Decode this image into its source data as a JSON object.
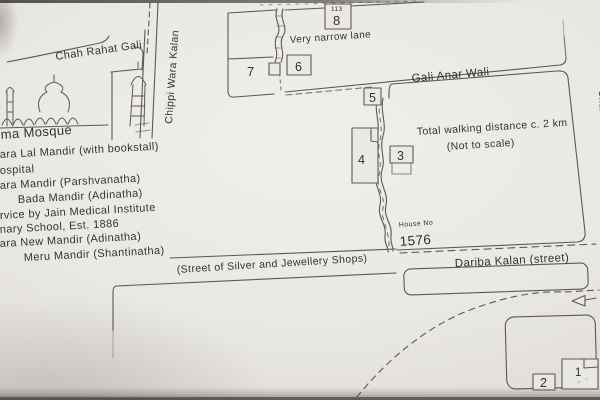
{
  "map": {
    "street_labels": {
      "chah_rahat_gali": "Chah Rahat Gali",
      "chippi_wara_kalan": "Chippi Wara Kalan",
      "very_narrow_lane": "Very narrow lane",
      "gali_anar_wali": "Gali Anar Wali",
      "silver_street": "(Street of Silver and Jewellery Shops)",
      "dariba_kalan": "Dariba Kalan (street)",
      "right_edge_street": "Chah"
    },
    "annotations": {
      "mosque": "ma Mosque",
      "house_no_label": "House No",
      "house_no_value": "1576",
      "walking_note_line1": "Total walking distance c. 2 km",
      "walking_note_line2": "(Not to scale)"
    },
    "markers": {
      "m1": "1",
      "m2": "2",
      "m3": "3",
      "m4": "4",
      "m5": "5",
      "m6": "6",
      "m7": "7",
      "m8": "8",
      "m8_sub": "113"
    },
    "legend": [
      "ara Lal Mandir (with bookstall)",
      "ospital",
      "ara Mandir (Parshvanatha)",
      "Bada Mandir (Adinatha)",
      "rvice by Jain Medical Institute",
      "nary School, Est. 1886",
      "ara New Mandir (Adinatha)",
      "Meru Mandir (Shantinatha)"
    ],
    "colors": {
      "ink": "#45423e",
      "paper": "#eae8e4"
    }
  }
}
